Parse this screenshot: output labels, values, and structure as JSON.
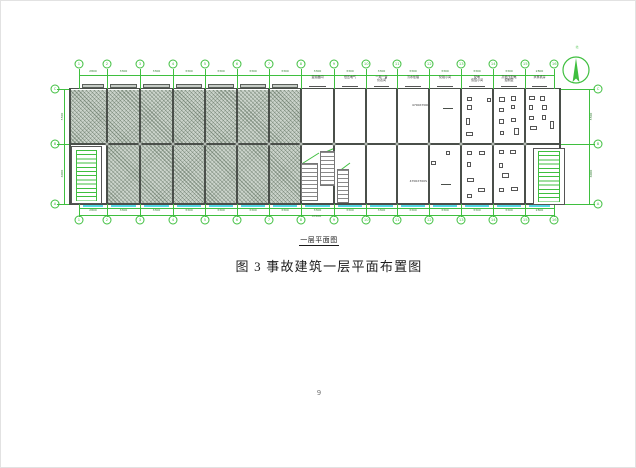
{
  "page": {
    "number": "9"
  },
  "figure": {
    "drawing_label": "一层平面图",
    "caption": "图 3 事故建筑一层平面布置图"
  },
  "plan": {
    "grid_labels": [
      "1",
      "2",
      "3",
      "4",
      "5",
      "6",
      "7",
      "8",
      "9",
      "10",
      "11",
      "12",
      "13",
      "14",
      "15",
      "16"
    ],
    "row_labels": [
      "C",
      "B",
      "A"
    ],
    "bay_dims": [
      "2800",
      "3300",
      "3300",
      "3300",
      "3300",
      "3300",
      "3300",
      "3300",
      "3300",
      "3300",
      "3300",
      "3300",
      "3300",
      "3300",
      "2800"
    ],
    "total_dim": "47600",
    "row_dims": [
      "5500",
      "6000"
    ],
    "north_label": "北",
    "room_labels": [
      {
        "bay": 7,
        "lines": [
          "变频器间"
        ]
      },
      {
        "bay": 8,
        "lines": [
          "低压电气"
        ]
      },
      {
        "bay": 9,
        "lines": [
          "一用一备",
          "仪表间"
        ]
      },
      {
        "bay": 10,
        "lines": [
          "污水处理"
        ]
      },
      {
        "bay": 11,
        "lines": [
          "化验小间"
        ]
      },
      {
        "bay": 12,
        "lines": [
          "配电",
          "值班小间"
        ]
      },
      {
        "bay": 13,
        "lines": [
          "高低压配电",
          "控制室"
        ]
      },
      {
        "bay": 14,
        "lines": [
          "水泵机房"
        ]
      }
    ],
    "annotations": [
      "4700X700L",
      "4700X700S"
    ],
    "colors": {
      "grid_green": "#3fbf3f",
      "window_cyan": "#55d8e6",
      "wall": "#4a4f4a",
      "hatch_bg": "#ccd4cc"
    }
  }
}
